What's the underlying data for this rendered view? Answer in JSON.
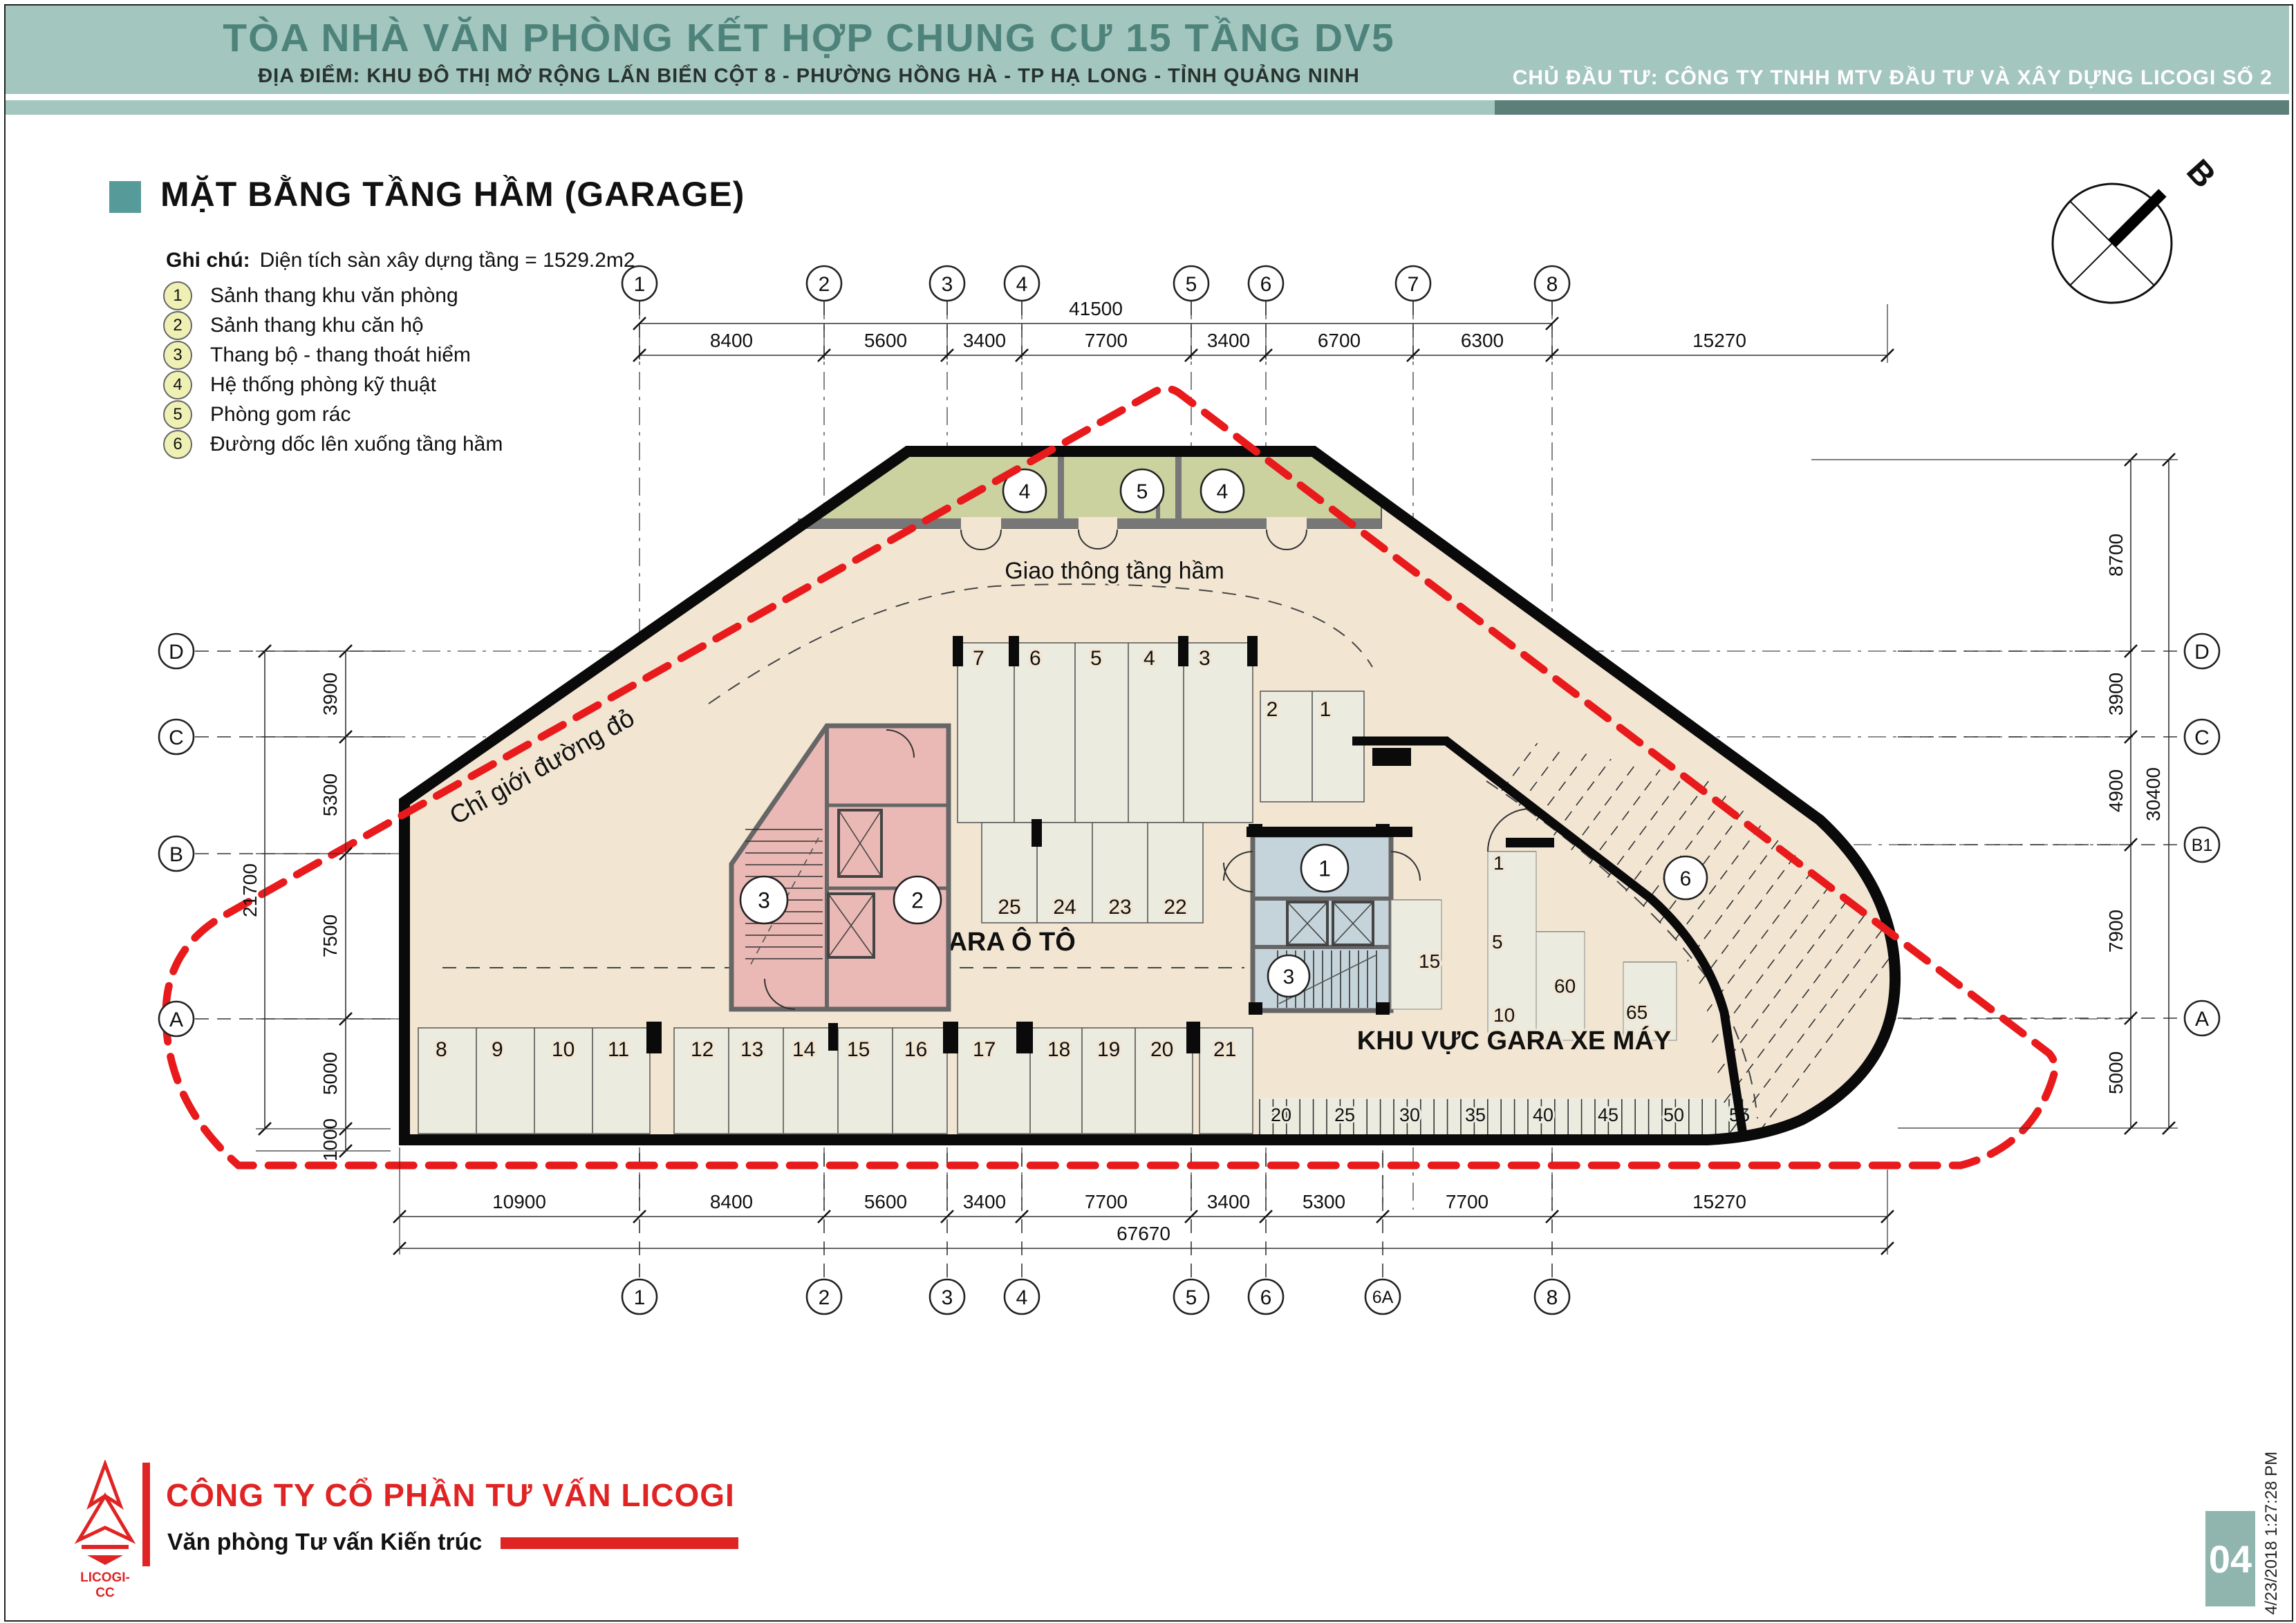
{
  "header": {
    "title": "TÒA NHÀ VĂN PHÒNG KẾT HỢP CHUNG CƯ 15 TẦNG DV5",
    "subtitle": "ĐỊA ĐIỂM: KHU ĐÔ THỊ MỞ RỘNG LẤN BIỂN CỘT 8 - PHƯỜNG HỒNG HÀ - TP HẠ LONG - TỈNH QUẢNG NINH",
    "investor": "CHỦ ĐẦU TƯ: CÔNG TY TNHH MTV ĐẦU TƯ VÀ XÂY DỰNG LICOGI SỐ 2"
  },
  "section": {
    "title": "MẶT BẰNG TẦNG HẦM (GARAGE)",
    "note_label": "Ghi chú:",
    "note_value": "Diện tích sàn xây dựng tầng = 1529.2m2"
  },
  "legend": [
    {
      "num": "1",
      "label": "Sảnh thang khu văn phòng"
    },
    {
      "num": "2",
      "label": "Sảnh thang khu căn hộ"
    },
    {
      "num": "3",
      "label": "Thang bộ - thang thoát hiểm"
    },
    {
      "num": "4",
      "label": "Hệ thống phòng kỹ thuật"
    },
    {
      "num": "5",
      "label": "Phòng gom rác"
    },
    {
      "num": "6",
      "label": "Đường dốc lên xuống tầng hầm"
    }
  ],
  "grid": {
    "cols_top": [
      "1",
      "2",
      "3",
      "4",
      "5",
      "6",
      "7",
      "8"
    ],
    "cols_bottom": [
      "1",
      "2",
      "3",
      "4",
      "5",
      "6",
      "6A",
      "8"
    ],
    "rows_left": [
      "D",
      "C",
      "B",
      "A"
    ],
    "rows_right": [
      "D",
      "C",
      "B1",
      "A"
    ]
  },
  "dims": {
    "top_total": "41500",
    "top_segments": [
      "8400",
      "5600",
      "3400",
      "7700",
      "3400",
      "6700",
      "6300",
      "15270"
    ],
    "bottom_segments": [
      "10900",
      "8400",
      "5600",
      "3400",
      "7700",
      "3400",
      "5300",
      "7700",
      "15270"
    ],
    "bottom_total": "67670",
    "left_segments": [
      "3900",
      "5300",
      "7500",
      "5000",
      "1000"
    ],
    "left_total": "21700",
    "right_segments": [
      "8700",
      "3900",
      "4900",
      "7900",
      "5000"
    ],
    "right_total": "30400"
  },
  "plan": {
    "labels": {
      "traffic": "Giao thông tầng hầm",
      "car_garage": "KHU VỰC GARA Ô TÔ",
      "moto_garage": "KHU VỰC GARA XE MÁY",
      "red_line": "Chỉ giới đường đỏ",
      "north": "B"
    },
    "room_bubbles_top": [
      "4",
      "5",
      "4"
    ],
    "core_pink_bubbles": [
      "3",
      "2"
    ],
    "core_blue_bubbles": [
      "1",
      "3"
    ],
    "ramp_bubble": "6",
    "car_spots_top": [
      "7",
      "6",
      "5",
      "4",
      "3"
    ],
    "car_spots_right": [
      "2",
      "1"
    ],
    "car_spots_mid": [
      "25",
      "24",
      "23",
      "22"
    ],
    "car_spots_bottom": [
      "8",
      "9",
      "10",
      "11",
      "12",
      "13",
      "14",
      "15",
      "16",
      "17",
      "18",
      "19",
      "20",
      "21"
    ],
    "moto_counts": [
      "1",
      "5",
      "10",
      "15",
      "60",
      "65"
    ],
    "moto_ticks": [
      "20",
      "25",
      "30",
      "35",
      "40",
      "45",
      "50",
      "55"
    ]
  },
  "footer": {
    "company": "CÔNG TY CỔ PHẦN TƯ VẤN LICOGI",
    "department": "Văn phòng Tư vấn Kiến trúc",
    "logo_text": "LICOGI-CC",
    "page_number": "04",
    "timestamp": "4/23/2018 1:27:28 PM"
  },
  "colors": {
    "header_band": "#a3c6be",
    "header_dark": "#5d7f79",
    "title_text": "#4e837b",
    "accent_teal": "#569b99",
    "floor": "#f2e6d3",
    "stall": "#ebebdf",
    "room_green": "#ccd1a0",
    "core_pink": "#eab9b5",
    "core_blue": "#c5d4da",
    "red_line": "#e81a1c",
    "brand_red": "#e02424",
    "badge": "#8fb5ae"
  }
}
